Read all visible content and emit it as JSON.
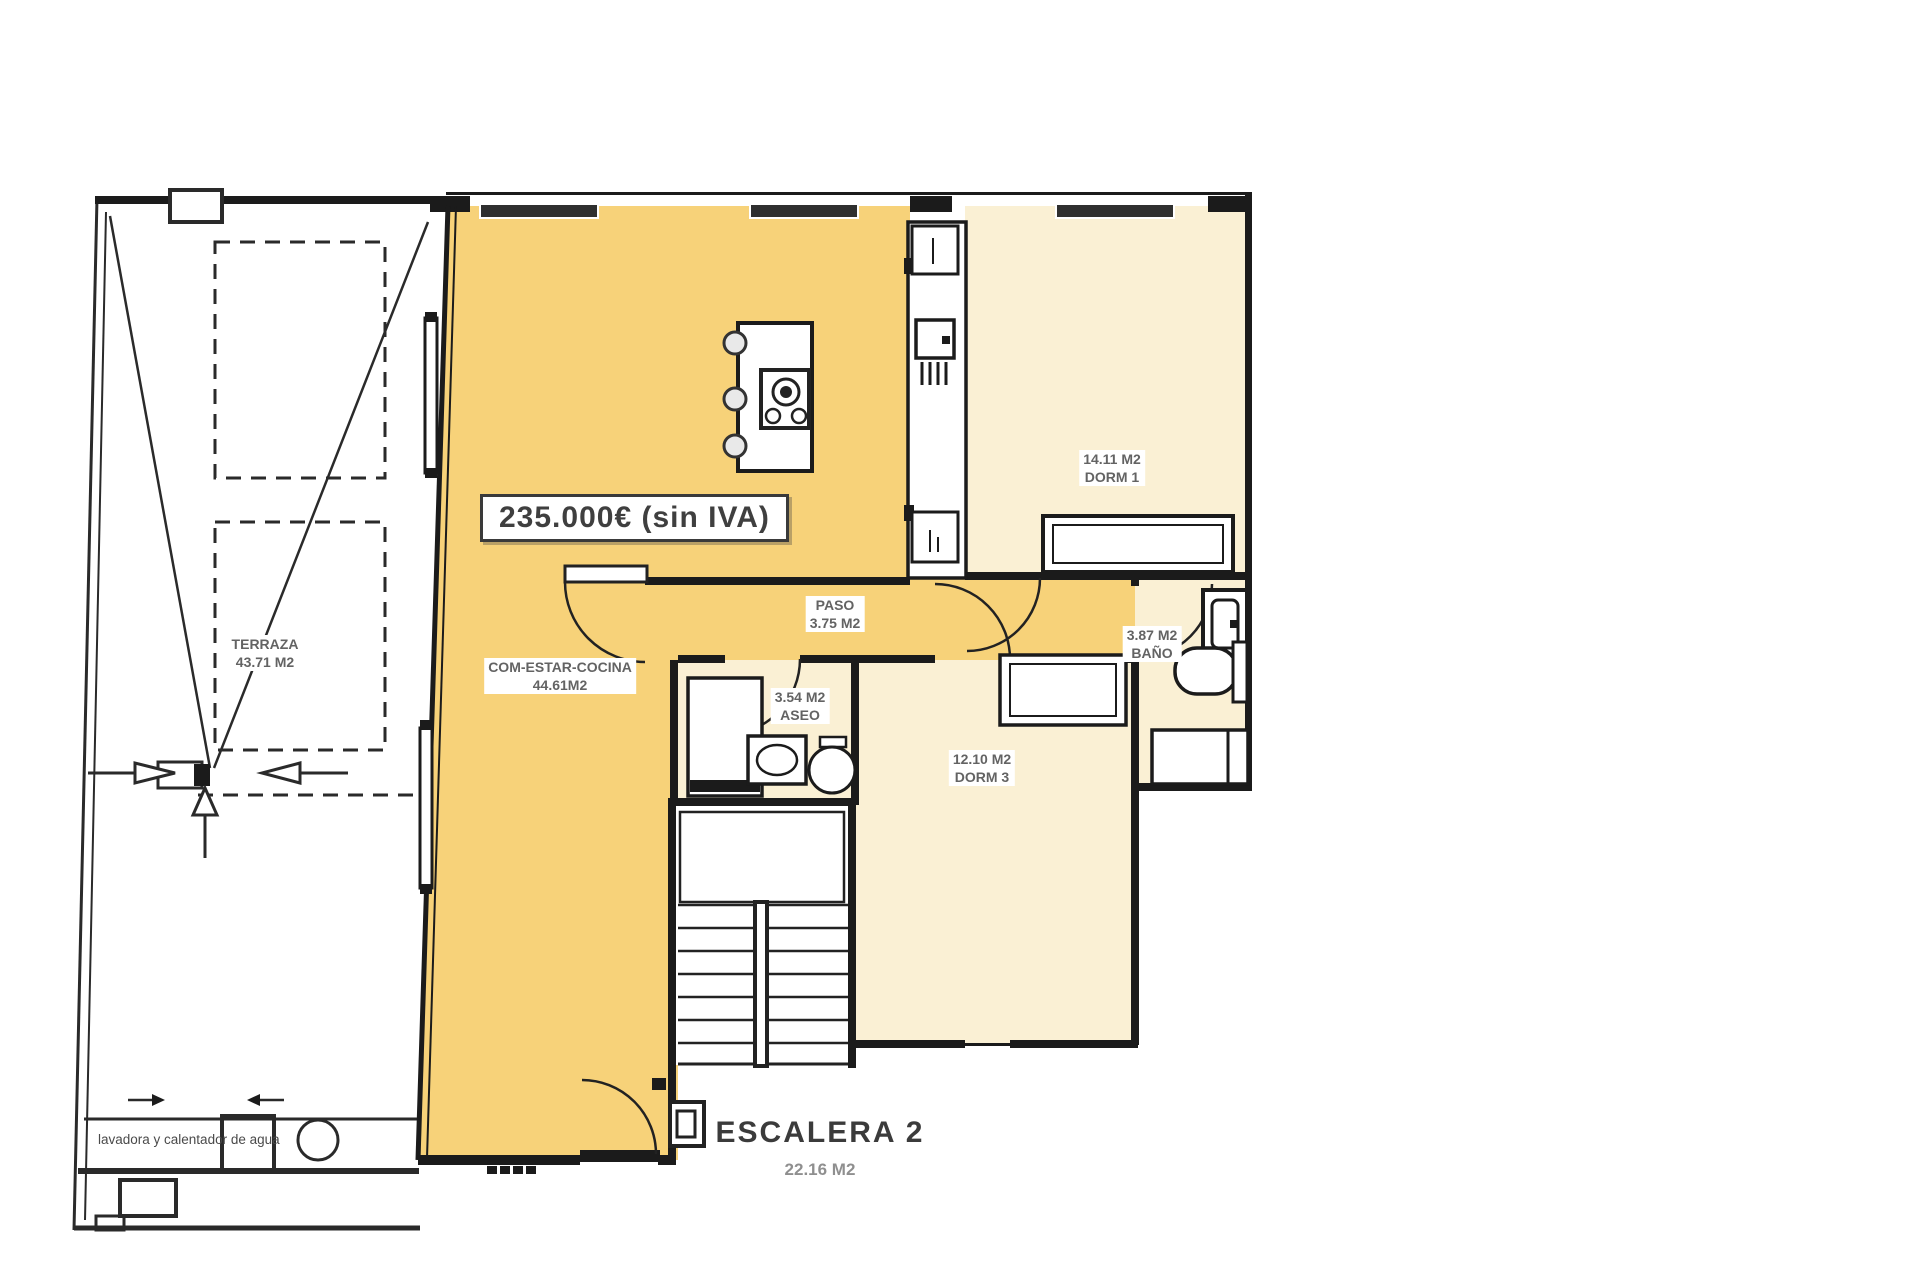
{
  "plan": {
    "price": "235.000€ (sin IVA)",
    "rooms": {
      "terraza": {
        "line1": "TERRAZA",
        "line2": "43.71 M2"
      },
      "salon": {
        "line1": "COM-ESTAR-COCINA",
        "line2": "44.61M2"
      },
      "paso": {
        "line1": "PASO",
        "line2": "3.75 M2"
      },
      "aseo": {
        "line1": "3.54 M2",
        "line2": "ASEO"
      },
      "dorm1": {
        "line1": "14.11 M2",
        "line2": "DORM 1"
      },
      "bano": {
        "line1": "3.87 M2",
        "line2": "BAÑO"
      },
      "dorm3": {
        "line1": "12.10 M2",
        "line2": "DORM 3"
      },
      "escalera": {
        "line1": "ESCALERA 2",
        "line2": "22.16 M2"
      }
    },
    "annotations": {
      "laundry": "lavadora y calentador de agua"
    },
    "colors": {
      "living": "#F7D279",
      "room_light": "#FAF0D4",
      "wall": "#1b1b1b",
      "background": "#FFFFFF"
    }
  }
}
